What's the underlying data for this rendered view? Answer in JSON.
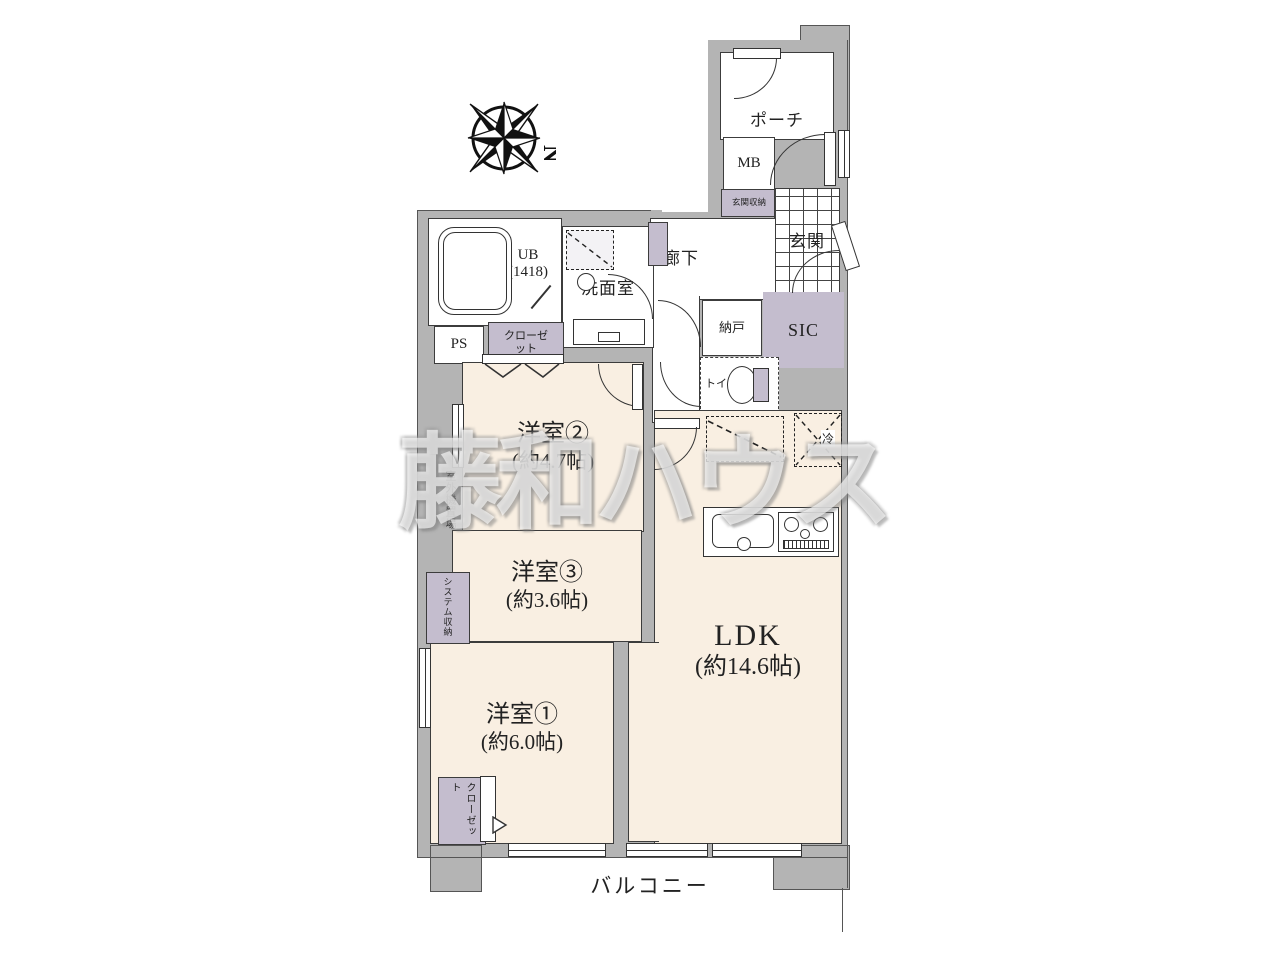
{
  "meta": {
    "watermark": "藤和ハウス",
    "compass_label": "N"
  },
  "rooms": {
    "porch": {
      "label": "ポーチ"
    },
    "mb": {
      "label": "MB"
    },
    "entrance_storage": {
      "label": "玄関収納"
    },
    "entrance": {
      "label": "玄関"
    },
    "corridor": {
      "label": "廊下"
    },
    "unit_bath": {
      "label": "UB",
      "size": "(1418)"
    },
    "washroom": {
      "label": "洗面室"
    },
    "pipe_space": {
      "label": "PS"
    },
    "closet_upper": {
      "label": "クローゼット"
    },
    "storage_room": {
      "label": "納戸"
    },
    "shoe_closet": {
      "label": "SIC"
    },
    "toilet": {
      "label": "トイレ"
    },
    "refrigerator": {
      "label": "冷"
    },
    "western_room_2": {
      "label": "洋室②",
      "size": "(約4.7帖)"
    },
    "western_room_3": {
      "label": "洋室③",
      "size": "(約3.6帖)"
    },
    "western_room_1": {
      "label": "洋室①",
      "size": "(約6.0帖)"
    },
    "ldk": {
      "label": "LDK",
      "size": "(約14.6帖)"
    },
    "balcony": {
      "label": "バルコニー"
    },
    "outdoor_unit_space": {
      "label": "室外機置場"
    },
    "system_storage": {
      "label": "システム収納"
    },
    "closet_lower": {
      "label": "クローゼット"
    }
  },
  "colors": {
    "wall": "#b4b4b4",
    "room_floor": "#f9efe2",
    "storage_accent": "#c4bdce",
    "line": "#3c3c3c",
    "background": "#ffffff"
  }
}
